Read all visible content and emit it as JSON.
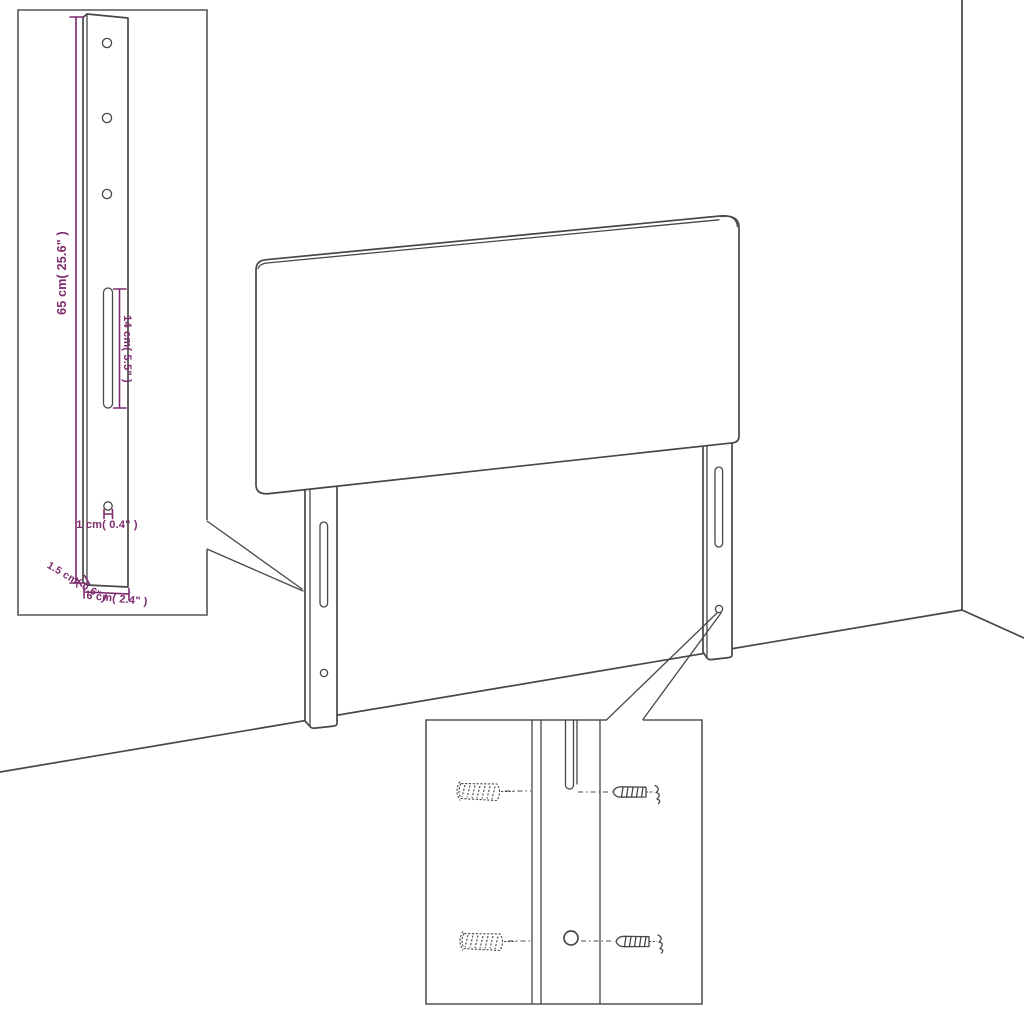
{
  "colors": {
    "line": "#474747",
    "dimension": "#7d2a6e",
    "background": "#ffffff",
    "box_border": "#555555"
  },
  "diagram": {
    "type": "furniture-dimension-diagram",
    "labels": {
      "leg_height": "65 cm( 25.6\" )",
      "slot_length": "14 cm( 5.5\" )",
      "hole_offset": "1 cm( 0.4\" )",
      "leg_depth": "1.5 cm( 0.6\" )",
      "leg_width": "6 cm( 2.4\" )"
    }
  }
}
